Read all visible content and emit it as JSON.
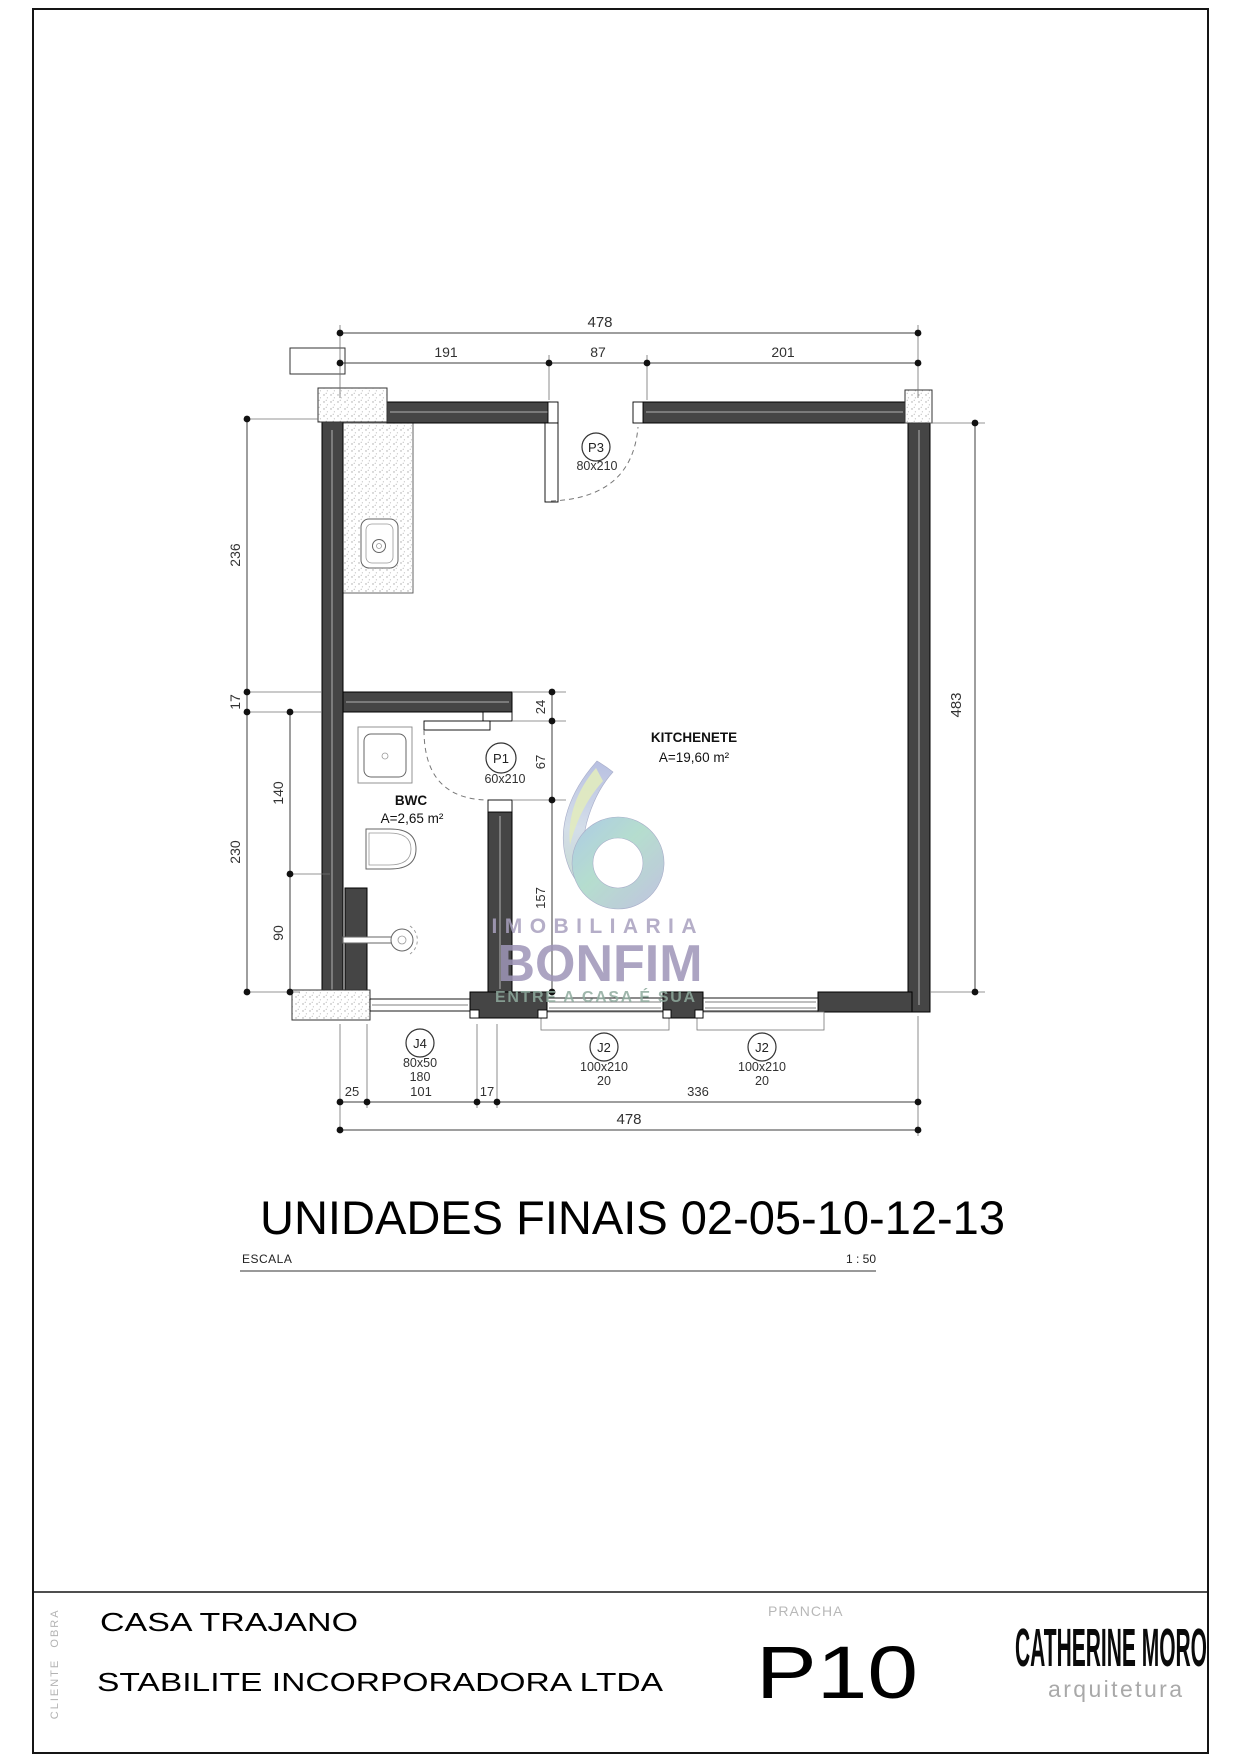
{
  "sheet": {
    "page_title": "UNIDADES FINAIS 02-05-10-12-13",
    "scale_label": "ESCALA",
    "scale_value": "1 : 50"
  },
  "rooms": {
    "kitchenete": {
      "name": "KITCHENETE",
      "area": "A=19,60 m²"
    },
    "bwc": {
      "name": "BWC",
      "area": "A=2,65 m²"
    }
  },
  "openings": {
    "p3": {
      "id": "P3",
      "size": "80x210"
    },
    "p1": {
      "id": "P1",
      "size": "60x210"
    },
    "j4": {
      "id": "J4",
      "size": "80x50",
      "sill": "180"
    },
    "j2a": {
      "id": "J2",
      "size": "100x210",
      "sill": "20"
    },
    "j2b": {
      "id": "J2",
      "size": "100x210",
      "sill": "20"
    }
  },
  "dims": {
    "top_total": "478",
    "top_a": "191",
    "top_b": "87",
    "top_c": "201",
    "left_a": "236",
    "left_b": "17",
    "left_c": "230",
    "left_inner_a": "140",
    "left_inner_b": "90",
    "right_total": "483",
    "mid_a": "24",
    "mid_b": "67",
    "mid_c": "157",
    "bottom_a": "25",
    "bottom_b": "101",
    "bottom_c": "17",
    "bottom_d": "336",
    "bottom_total": "478"
  },
  "watermark": {
    "line1": "IMOBILIARIA",
    "line2": "BONFIM",
    "line3": "ENTRE A CASA É SUA"
  },
  "title_block": {
    "obra_label": "OBRA",
    "obra_value": "CASA TRAJANO",
    "cliente_label": "CLIENTE",
    "cliente_value": "STABILITE INCORPORADORA LTDA",
    "prancha_label": "PRANCHA",
    "prancha_value": "P10",
    "firm_name": "CATHERINE MORO",
    "firm_tagline": "arquitetura"
  },
  "colors": {
    "wall_fill": "#454545",
    "dim_line": "#3c3c3c",
    "watermark_purple": "#9e95b8",
    "watermark_teal": "#8fab9e",
    "logo_blue": "#9fc2e2",
    "logo_green": "#a9d8c6",
    "logo_lavender": "#b6b9db",
    "logo_yellow_green": "#dde8b4"
  }
}
